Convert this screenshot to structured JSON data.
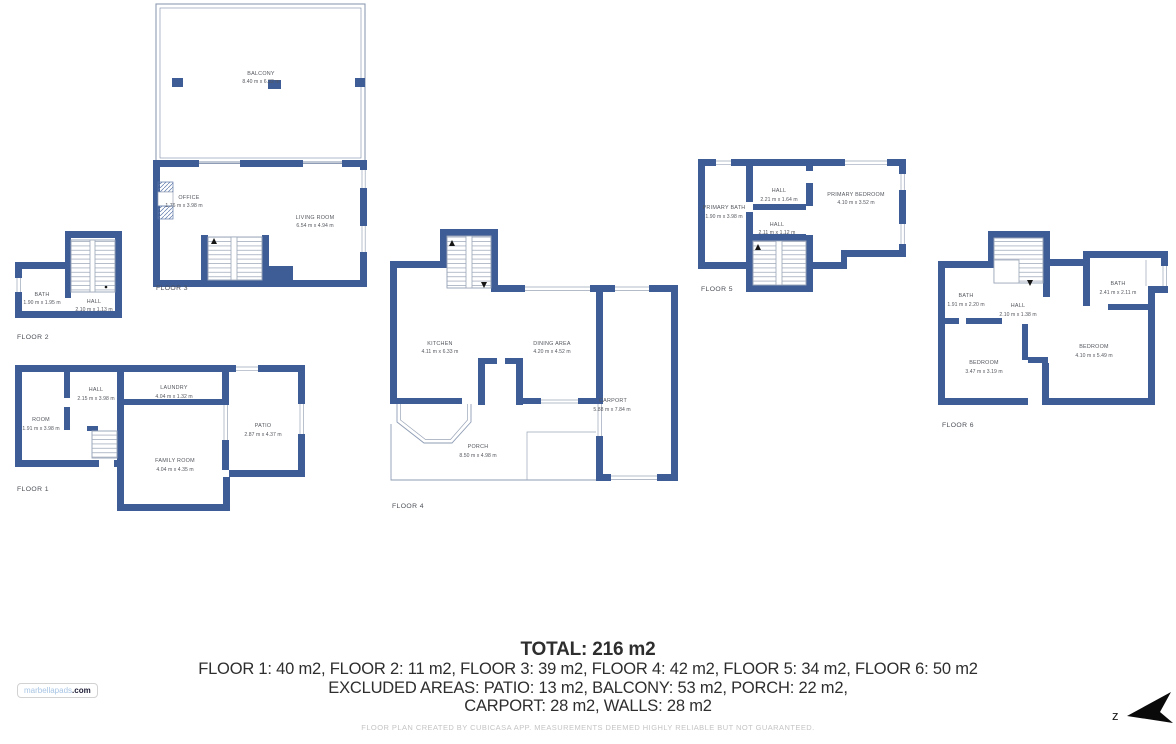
{
  "branding": {
    "logo_name": "marbellapads",
    "logo_tld": ".com"
  },
  "compass": {
    "letter": "z"
  },
  "summary": {
    "total": "TOTAL: 216 m2",
    "line1": "FLOOR 1: 40 m2, FLOOR 2: 11 m2, FLOOR 3: 39 m2, FLOOR 4: 42 m2, FLOOR 5: 34 m2, FLOOR 6: 50 m2",
    "line2": "EXCLUDED AREAS: PATIO: 13 m2, BALCONY: 53 m2, PORCH: 22 m2,",
    "line3": "CARPORT: 28 m2, WALLS: 28 m2"
  },
  "disclaimer": "FLOOR PLAN CREATED BY CUBICASA APP. MEASUREMENTS DEEMED HIGHLY RELIABLE BUT NOT GUARANTEED.",
  "colors": {
    "wall": "#3e5c95",
    "thin_line": "#8e9cb5",
    "plan_text": "#54575e",
    "summary_text": "#2e2e2e",
    "disclaimer_text": "#c4c4c4",
    "logo_blue": "#a7c4e4"
  },
  "floors": [
    {
      "label": "FLOOR 1",
      "rooms": [
        {
          "name": "ROOM",
          "dims": "1.91 m x 3.98 m"
        },
        {
          "name": "HALL",
          "dims": "2.15 m x 3.98 m"
        },
        {
          "name": "LAUNDRY",
          "dims": "4.04 m x 1.32 m"
        },
        {
          "name": "PATIO",
          "dims": "2.87 m x 4.37 m"
        },
        {
          "name": "FAMILY ROOM",
          "dims": "4.04 m x 4.35 m"
        }
      ]
    },
    {
      "label": "FLOOR 2",
      "rooms": [
        {
          "name": "BATH",
          "dims": "1.90 m x 1.95 m"
        },
        {
          "name": "HALL",
          "dims": "2.10 m x 1.13 m"
        }
      ]
    },
    {
      "label": "FLOOR 3",
      "rooms": [
        {
          "name": "BALCONY",
          "dims": "8.40 m x 6.32 m"
        },
        {
          "name": "OFFICE",
          "dims": "1.76 m x 3.98 m"
        },
        {
          "name": "LIVING ROOM",
          "dims": "6.54 m x 4.94 m"
        }
      ]
    },
    {
      "label": "FLOOR 4",
      "rooms": [
        {
          "name": "KITCHEN",
          "dims": "4.11 m x 6.33 m"
        },
        {
          "name": "DINING AREA",
          "dims": "4.20 m x 4.52 m"
        },
        {
          "name": "CARPORT",
          "dims": "5.88 m x 7.84 m"
        },
        {
          "name": "PORCH",
          "dims": "8.50 m x 4.98 m"
        }
      ]
    },
    {
      "label": "FLOOR 5",
      "rooms": [
        {
          "name": "PRIMARY BATH",
          "dims": "1.90 m x 3.98 m"
        },
        {
          "name": "HALL",
          "dims": "2.21 m x 1.64 m"
        },
        {
          "name": "HALL",
          "dims": "2.11 m x 1.12 m"
        },
        {
          "name": "PRIMARY BEDROOM",
          "dims": "4.10 m x 3.52 m"
        }
      ]
    },
    {
      "label": "FLOOR 6",
      "rooms": [
        {
          "name": "BATH",
          "dims": "1.91 m x 2.20 m"
        },
        {
          "name": "HALL",
          "dims": "2.10 m x 1.38 m"
        },
        {
          "name": "BATH",
          "dims": "2.41 m x 2.11 m"
        },
        {
          "name": "BEDROOM",
          "dims": "3.47 m x 3.19 m"
        },
        {
          "name": "BEDROOM",
          "dims": "4.10 m x 5.49 m"
        }
      ]
    }
  ]
}
